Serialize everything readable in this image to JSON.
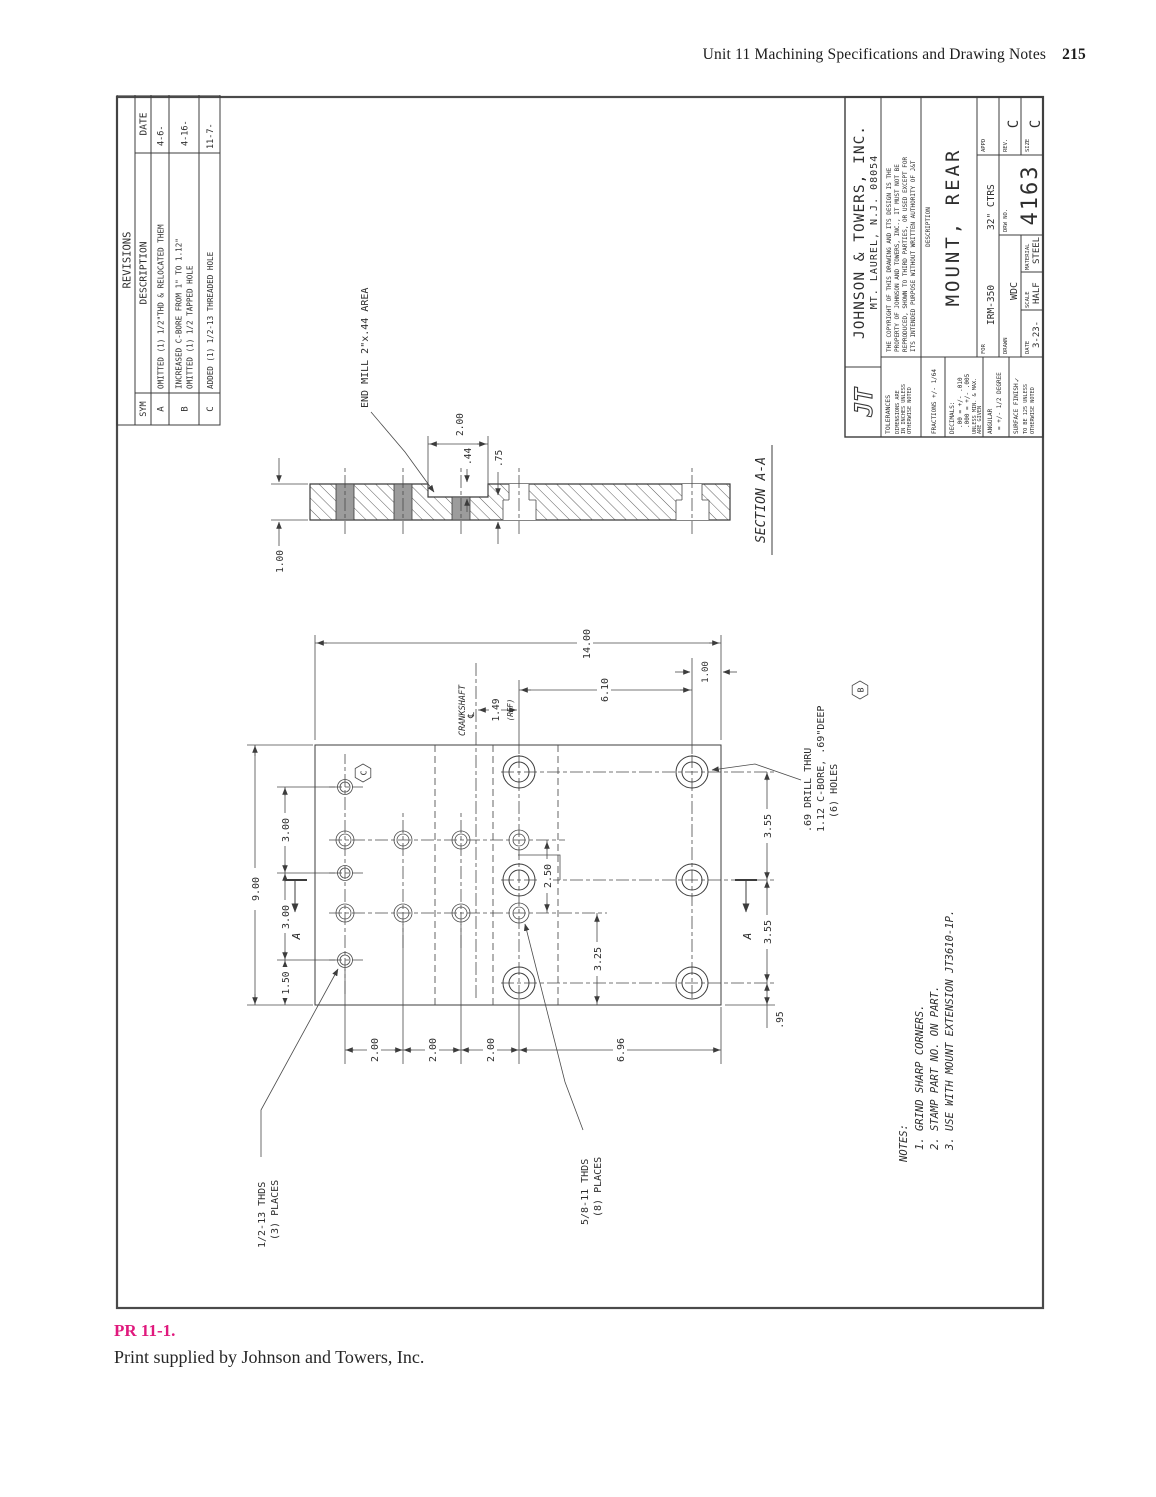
{
  "page": {
    "header": {
      "title": "Unit 11  Machining Specifications and Drawing Notes",
      "page_number": "215"
    },
    "caption": {
      "label": "PR 11-1.",
      "text": "Print supplied by Johnson and Towers, Inc.",
      "accent_color": "#e0197d"
    }
  },
  "revisions": {
    "title": "REVISIONS",
    "col_sym": "SYM",
    "col_description": "DESCRIPTION",
    "col_date": "DATE",
    "rows": [
      {
        "sym": "A",
        "line1": "OMITTED (1) 1/2\"THD & RELOCATED THEM",
        "line2": "",
        "date": "4-6-"
      },
      {
        "sym": "B",
        "line1": "INCREASED C-BORE FROM 1\" TO 1.12\"",
        "line2": "OMITTED (1) 1/2 TAPPED HOLE",
        "date": "4-16-"
      },
      {
        "sym": "C",
        "line1": "ADDED (1) 1/2-13 THREADED HOLE",
        "line2": "",
        "date": "11-7-"
      }
    ]
  },
  "title_block": {
    "logo": "JT",
    "company": "JOHNSON & TOWERS, INC.",
    "address": "MT. LAUREL, N.J. 08054",
    "copyright": [
      "THE COPYRIGHT OF THIS DRAWING AND ITS DESIGN IS THE",
      "PROPERTY OF JOHNSON AND TOWERS, INC., IT MUST NOT BE",
      "REPRODUCED, SHOWN TO THIRD PARTIES, OR USED EXCEPT FOR",
      "ITS INTENDED PURPOSE WITHOUT WRITTEN AUTHORITY OF J&T"
    ],
    "tolerances_label": "TOLERANCES",
    "tol_note1": "DIMENSIONS ARE",
    "tol_note2": "IN INCHES UNLESS",
    "tol_note3": "OTHERWISE NOTED",
    "fractions": "FRACTIONS +/- 1/64",
    "decimals_label": "DECIMALS:",
    "decimals1": ".00 = +/- .010",
    "decimals2": ".000 = +/- .005",
    "decimals_note1": "UNLESS MIN. & MAX.",
    "decimals_note2": "ARE GIVEN",
    "angular_label": "ANGULAR",
    "angular_value": "= +/- 1/2 DEGREE",
    "surface1": "SURFACE FINISH",
    "surface_check": "✓",
    "surface2": "TO BE 125 UNLESS",
    "surface3": "OTHERWISE NOTED",
    "description_label": "DESCRIPTION",
    "description": "MOUNT, REAR",
    "for_label": "FOR",
    "for_value": "IRM-350",
    "ctrs": "32\" CTRS",
    "appd_label": "APPD",
    "drawn_label": "DRAWN",
    "drawn": "WDC",
    "date_label": "DATE",
    "date": "3-23-",
    "scale_label": "SCALE",
    "scale": "HALF",
    "material_label": "MATERIAL",
    "material": "STEEL",
    "drw_no_label": "DRW NO.",
    "drw_no": "4163",
    "rev_label": "REV.",
    "rev": "C",
    "size_label": "SIZE",
    "size": "C"
  },
  "drawing": {
    "dims": {
      "overall_width": "9.00",
      "top_chain": [
        "1.50",
        "3.00",
        "3.00"
      ],
      "left_chain": [
        "2.00",
        "2.00",
        "2.00",
        "6.96"
      ],
      "overall_height": "14.00",
      "hole_rows": "6.10",
      "bottom_offset": "1.00",
      "bottom_chain": [
        ".95",
        "3.55",
        "3.55"
      ],
      "pair_spacing": "2.50",
      "edge_to_col": "3.25",
      "crank_ref": "1.49",
      "crank_ref_note": "(REF)",
      "thickness": "1.00",
      "notch_length": "2.00",
      "notch_depth": ".44",
      "remaining": ".75"
    },
    "labels": {
      "crankshaft": "CRANKSHAFT",
      "cl_symbol": "℄",
      "end_mill": "END MILL 2\"x.44 AREA",
      "half_thds1": "1/2-13 THDS",
      "half_thds2": "(3) PLACES",
      "five8_thds1": "5/8-11 THDS",
      "five8_thds2": "(8) PLACES",
      "cbore1": ".69 DRILL THRU",
      "cbore2": "1.12 C-BORE, .69\"DEEP",
      "cbore3": "(6) HOLES",
      "section": "SECTION A-A",
      "arrow_a": "A",
      "flag_b": "B",
      "flag_c": "C"
    },
    "notes": [
      "NOTES:",
      "1. GRIND SHARP CORNERS.",
      "2. STAMP PART NO. ON PART.",
      "3. USE WITH MOUNT EXTENSION JT3610-1P."
    ]
  }
}
